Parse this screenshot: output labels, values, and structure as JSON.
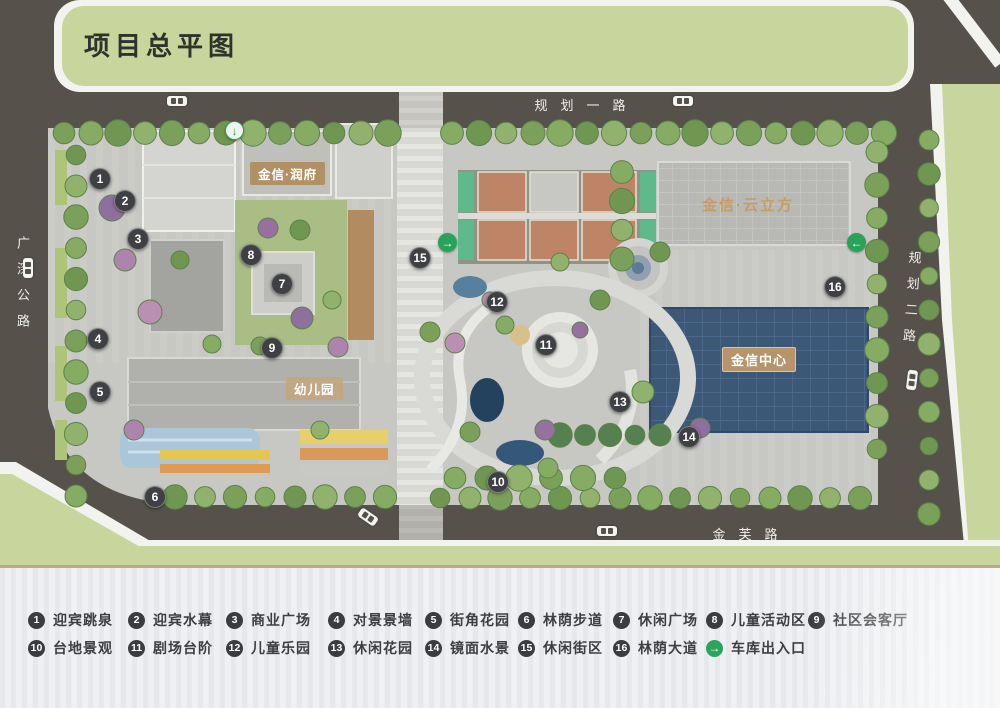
{
  "title": "项目总平图",
  "roads": {
    "top": "规划一路",
    "left": "广深公路",
    "right": "规划二路",
    "bottom": "金芙路"
  },
  "buildings": {
    "runfu": "金信·润府",
    "yunlifang": "金信·云立方",
    "jinxin_center": "金信中心",
    "kindergarten": "幼儿园"
  },
  "markers": [
    {
      "n": "1",
      "x": 100,
      "y": 179
    },
    {
      "n": "2",
      "x": 125,
      "y": 201
    },
    {
      "n": "3",
      "x": 138,
      "y": 239
    },
    {
      "n": "4",
      "x": 98,
      "y": 339
    },
    {
      "n": "5",
      "x": 100,
      "y": 392
    },
    {
      "n": "6",
      "x": 155,
      "y": 497
    },
    {
      "n": "7",
      "x": 282,
      "y": 284
    },
    {
      "n": "8",
      "x": 251,
      "y": 255
    },
    {
      "n": "9",
      "x": 272,
      "y": 348
    },
    {
      "n": "10",
      "x": 498,
      "y": 482
    },
    {
      "n": "11",
      "x": 546,
      "y": 345
    },
    {
      "n": "12",
      "x": 497,
      "y": 302
    },
    {
      "n": "13",
      "x": 620,
      "y": 402
    },
    {
      "n": "14",
      "x": 689,
      "y": 437
    },
    {
      "n": "15",
      "x": 420,
      "y": 258
    },
    {
      "n": "16",
      "x": 835,
      "y": 287
    }
  ],
  "garage_arrows": [
    {
      "glyph": "↓",
      "x": 235,
      "y": 131,
      "variant": "light"
    },
    {
      "glyph": "→",
      "x": 448,
      "y": 243,
      "variant": "solid"
    },
    {
      "glyph": "←",
      "x": 857,
      "y": 243,
      "variant": "solid"
    }
  ],
  "legend": {
    "row1": [
      {
        "n": "1",
        "label": "迎宾跳泉"
      },
      {
        "n": "2",
        "label": "迎宾水幕"
      },
      {
        "n": "3",
        "label": "商业广场"
      },
      {
        "n": "4",
        "label": "对景景墙"
      },
      {
        "n": "5",
        "label": "街角花园"
      },
      {
        "n": "6",
        "label": "林荫步道"
      },
      {
        "n": "7",
        "label": "休闲广场"
      },
      {
        "n": "8",
        "label": "儿童活动区"
      },
      {
        "n": "9",
        "label": "社区会客厅"
      }
    ],
    "row2": [
      {
        "n": "10",
        "label": "台地景观"
      },
      {
        "n": "11",
        "label": "剧场台阶"
      },
      {
        "n": "12",
        "label": "儿童乐园"
      },
      {
        "n": "13",
        "label": "休闲花园"
      },
      {
        "n": "14",
        "label": "镜面水景"
      },
      {
        "n": "15",
        "label": "休闲街区"
      },
      {
        "n": "16",
        "label": "林荫大道"
      },
      {
        "n": "→",
        "label": "车库出入口",
        "type": "arrow"
      }
    ]
  },
  "colors": {
    "road": "#56524b",
    "green_band": "#c8d59c",
    "site": "#c7c7c3",
    "marker": "#3e4044",
    "garage_green": "#27a35a",
    "center_building": "#3d5877",
    "label_tan": "#b8946b",
    "court": "#bd8465",
    "court_end": "#5fb98b",
    "legend_rule": "#c9a38b"
  }
}
